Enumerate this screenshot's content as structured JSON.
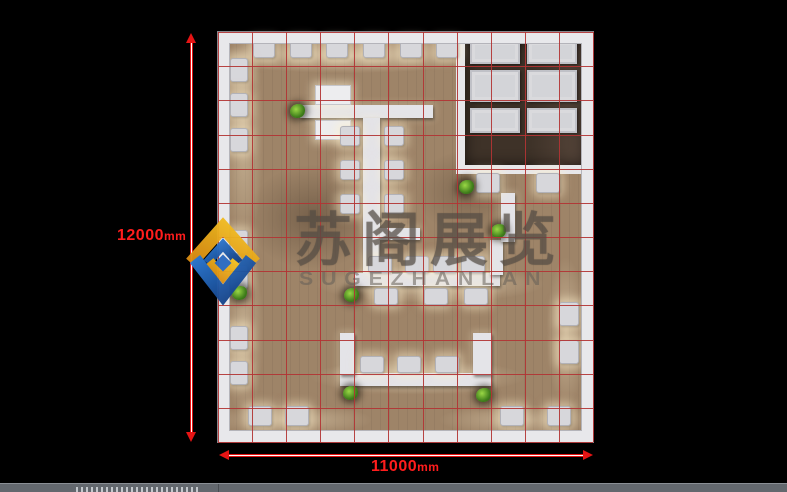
{
  "watermark": {
    "cn": "苏阁展览",
    "en": "SUGEZHANLAN"
  },
  "dimensions": {
    "vertical": {
      "value": "12000",
      "unit": "mm"
    },
    "horizontal": {
      "value": "11000",
      "unit": "mm"
    }
  },
  "colors": {
    "background": "#000000",
    "dimension_red": "#e61414",
    "grid_red": "#b23434",
    "wall_white": "#e8e8eb",
    "floor_tan": "#9e8468",
    "room_dark_floor": "#3e3228",
    "statusbar_gray": "#63686e",
    "logo_blue": "#1c55a8",
    "logo_yellow": "#eeb01e"
  },
  "floorplan": {
    "grid": {
      "cols": 11,
      "rows": 12
    },
    "room": {
      "x": 238,
      "y": 0,
      "w": 137,
      "h": 142
    },
    "panels": [
      {
        "x": 252,
        "y": 8,
        "w": 50,
        "h": 24
      },
      {
        "x": 309,
        "y": 8,
        "w": 50,
        "h": 24
      },
      {
        "x": 252,
        "y": 38,
        "w": 50,
        "h": 32
      },
      {
        "x": 309,
        "y": 38,
        "w": 50,
        "h": 32
      },
      {
        "x": 252,
        "y": 76,
        "w": 50,
        "h": 25
      },
      {
        "x": 309,
        "y": 76,
        "w": 50,
        "h": 25
      }
    ],
    "counters": [
      {
        "x": 82,
        "y": 73,
        "w": 133,
        "h": 13
      },
      {
        "x": 145,
        "y": 86,
        "w": 17,
        "h": 157
      },
      {
        "x": 162,
        "y": 196,
        "w": 40,
        "h": 12
      },
      {
        "x": 137,
        "y": 241,
        "w": 145,
        "h": 13
      },
      {
        "x": 272,
        "y": 208,
        "w": 13,
        "h": 35
      },
      {
        "x": 283,
        "y": 161,
        "w": 14,
        "h": 49
      },
      {
        "x": 122,
        "y": 341,
        "w": 152,
        "h": 13
      },
      {
        "x": 122,
        "y": 301,
        "w": 15,
        "h": 42
      },
      {
        "x": 255,
        "y": 301,
        "w": 19,
        "h": 42
      }
    ],
    "tables": [
      {
        "x": 97,
        "y": 53,
        "w": 36,
        "h": 20
      },
      {
        "x": 97,
        "y": 88,
        "w": 36,
        "h": 20
      }
    ],
    "seats": [
      {
        "x": 35,
        "y": 8,
        "w": 22,
        "h": 18
      },
      {
        "x": 72,
        "y": 8,
        "w": 22,
        "h": 18
      },
      {
        "x": 108,
        "y": 8,
        "w": 22,
        "h": 18
      },
      {
        "x": 145,
        "y": 8,
        "w": 22,
        "h": 18
      },
      {
        "x": 182,
        "y": 8,
        "w": 22,
        "h": 18
      },
      {
        "x": 218,
        "y": 8,
        "w": 22,
        "h": 18
      },
      {
        "x": 12,
        "y": 26,
        "w": 18,
        "h": 24
      },
      {
        "x": 12,
        "y": 61,
        "w": 18,
        "h": 24
      },
      {
        "x": 12,
        "y": 96,
        "w": 18,
        "h": 24
      },
      {
        "x": 12,
        "y": 198,
        "w": 18,
        "h": 24
      },
      {
        "x": 12,
        "y": 233,
        "w": 18,
        "h": 24
      },
      {
        "x": 12,
        "y": 294,
        "w": 18,
        "h": 24
      },
      {
        "x": 12,
        "y": 329,
        "w": 18,
        "h": 24
      },
      {
        "x": 30,
        "y": 374,
        "w": 24,
        "h": 20
      },
      {
        "x": 67,
        "y": 374,
        "w": 24,
        "h": 20
      },
      {
        "x": 282,
        "y": 374,
        "w": 24,
        "h": 20
      },
      {
        "x": 329,
        "y": 374,
        "w": 24,
        "h": 20
      },
      {
        "x": 341,
        "y": 270,
        "w": 20,
        "h": 24
      },
      {
        "x": 341,
        "y": 308,
        "w": 20,
        "h": 24
      },
      {
        "x": 258,
        "y": 141,
        "w": 24,
        "h": 20
      },
      {
        "x": 318,
        "y": 141,
        "w": 24,
        "h": 20
      },
      {
        "x": 122,
        "y": 94,
        "w": 20,
        "h": 20
      },
      {
        "x": 122,
        "y": 128,
        "w": 20,
        "h": 20
      },
      {
        "x": 122,
        "y": 162,
        "w": 20,
        "h": 20
      },
      {
        "x": 166,
        "y": 94,
        "w": 20,
        "h": 20
      },
      {
        "x": 166,
        "y": 128,
        "w": 20,
        "h": 20
      },
      {
        "x": 166,
        "y": 162,
        "w": 20,
        "h": 20
      },
      {
        "x": 150,
        "y": 224,
        "w": 24,
        "h": 17
      },
      {
        "x": 187,
        "y": 224,
        "w": 24,
        "h": 17
      },
      {
        "x": 215,
        "y": 224,
        "w": 24,
        "h": 17
      },
      {
        "x": 243,
        "y": 224,
        "w": 24,
        "h": 17
      },
      {
        "x": 156,
        "y": 256,
        "w": 24,
        "h": 17
      },
      {
        "x": 206,
        "y": 256,
        "w": 24,
        "h": 17
      },
      {
        "x": 246,
        "y": 256,
        "w": 24,
        "h": 17
      },
      {
        "x": 142,
        "y": 324,
        "w": 24,
        "h": 17
      },
      {
        "x": 179,
        "y": 324,
        "w": 24,
        "h": 17
      },
      {
        "x": 217,
        "y": 324,
        "w": 24,
        "h": 17
      }
    ],
    "plants": [
      {
        "x": 72,
        "y": 72
      },
      {
        "x": 14,
        "y": 254
      },
      {
        "x": 126,
        "y": 256
      },
      {
        "x": 241,
        "y": 148
      },
      {
        "x": 273,
        "y": 192
      },
      {
        "x": 125,
        "y": 354
      },
      {
        "x": 258,
        "y": 356
      }
    ]
  }
}
